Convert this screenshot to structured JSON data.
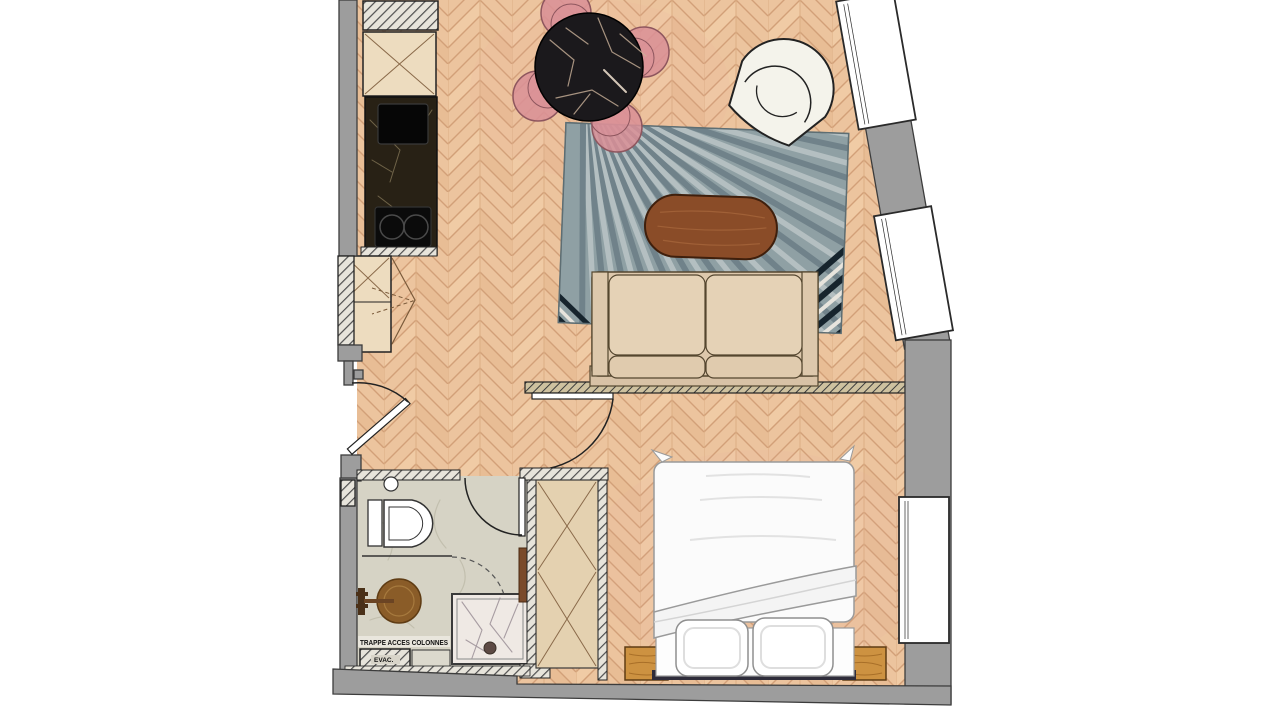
{
  "plan": {
    "labels": {
      "trappe_acces": "TRAPPE ACCES COLONNES",
      "evac": "EVAC."
    },
    "palette": {
      "exterior": "#ffffff",
      "wall_gray": "#9d9d9d",
      "wall_outline": "#3c3c3c",
      "parquet": "#ecc49e",
      "parquet_line": "#d2a078",
      "bathroom_floor": "#d6d3c5",
      "rug_base": "#8fa0a4",
      "rug_ray_light": "#b4bfc1",
      "rug_ray_dark": "#70828a",
      "rug_corner_dark": "#16242d",
      "sofa": "#ddc8ac",
      "sofa_cushion": "#e5d2b6",
      "coffee_table": "#8a4c28",
      "dining_table": "#1b191c",
      "chair_pink": "#d98f97",
      "cabinet": "#eddcbf",
      "counter_marble": "#282115",
      "appliance_black": "#0b0b0b",
      "closet": "#e4d1b0",
      "nightstand_wood": "#cd9241",
      "bed_white": "#fbfbfb",
      "basin_bronze": "#8a5c28",
      "armchair": "#f4f3eb",
      "window_white": "#ffffff"
    },
    "elements": [
      "technical-shaft",
      "tall-cabinet",
      "kitchen-counter",
      "kitchen-sink",
      "cooktop",
      "entry-closet",
      "entry-door",
      "dining-table",
      "dining-chair",
      "area-rug",
      "coffee-table",
      "sofa",
      "armchair",
      "partition-wall",
      "bedroom-door",
      "bathroom-floor",
      "toilet",
      "washbasin",
      "shower",
      "bathroom-door",
      "wardrobe",
      "bed",
      "pillow",
      "nightstand",
      "window",
      "evac-hatch"
    ]
  }
}
